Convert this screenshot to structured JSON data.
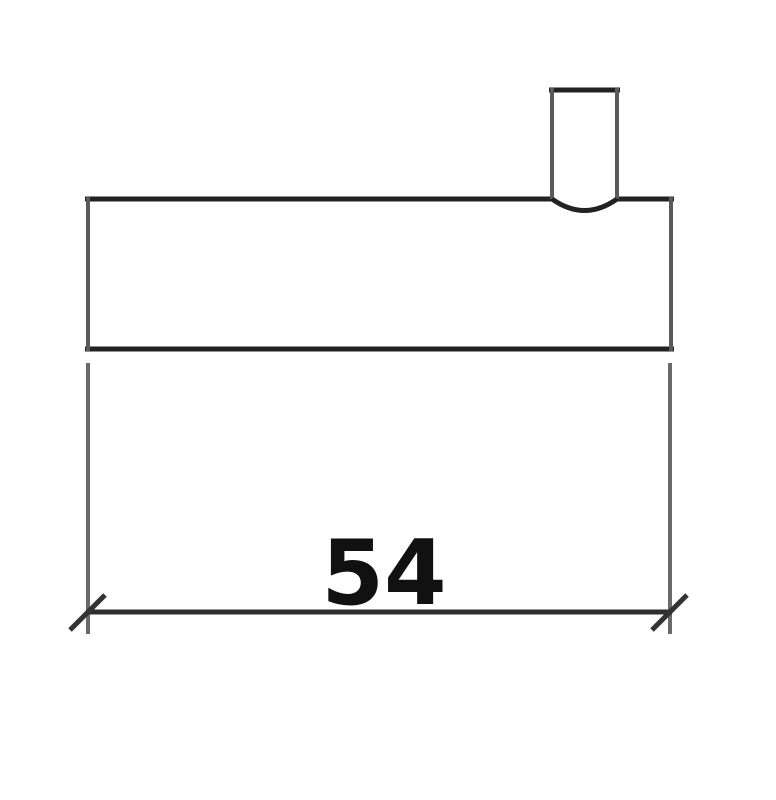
{
  "drawing": {
    "type": "technical-dimension-drawing",
    "dimension_label": "54",
    "colors": {
      "background": "#ffffff",
      "outline_dark": "#222222",
      "outline_gray": "#5a5a5a",
      "extension_gray": "#6a6a6a",
      "dimension_line": "#2e2e2e",
      "tick": "#333333",
      "label_text": "#111111"
    }
  }
}
